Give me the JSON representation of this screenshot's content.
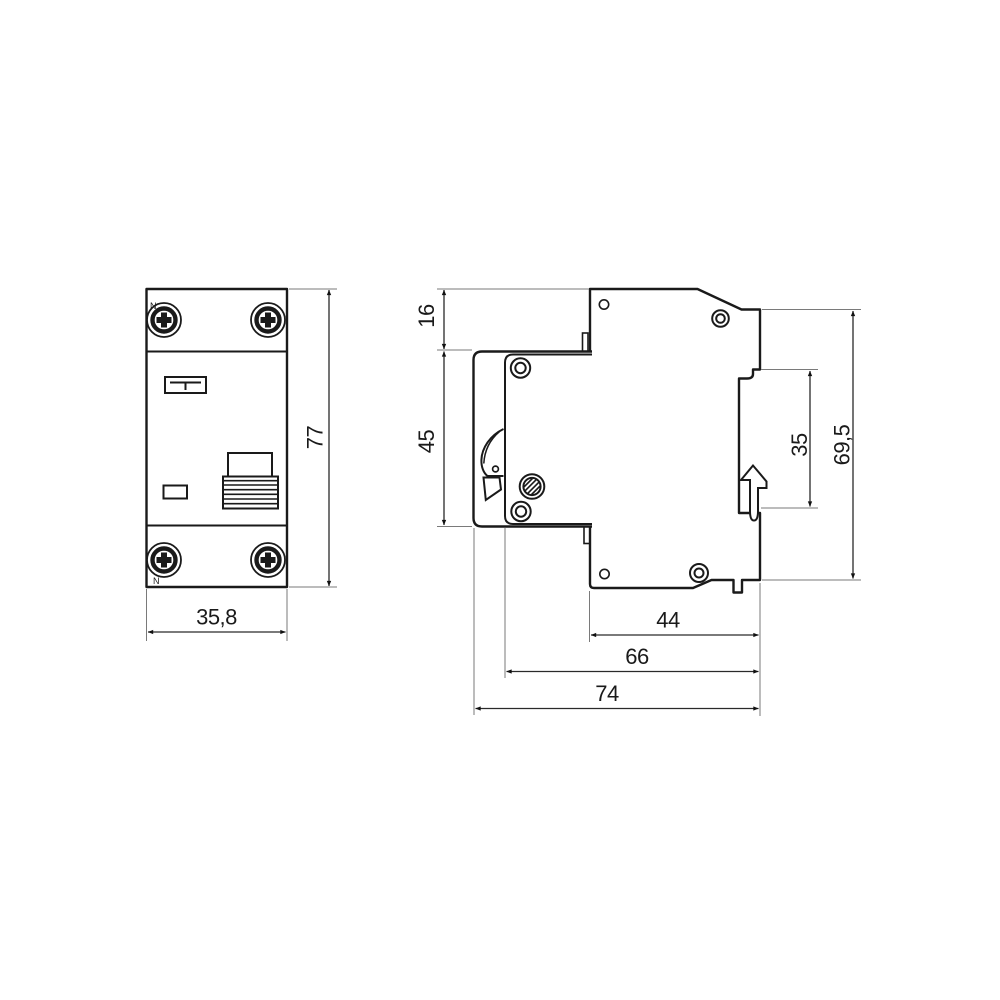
{
  "drawing": {
    "description": "Two-view dimensional drawing of a DIN-rail RCBO circuit breaker",
    "front_view": {
      "terminal_label_top": "N",
      "terminal_label_bottom": "N",
      "dim_width": "35,8",
      "dim_height": "77"
    },
    "side_view": {
      "dim_top_section": "16",
      "dim_front_panel": "45",
      "dim_rail_recess": "35",
      "dim_body_height": "69,5",
      "dim_depth_rear": "44",
      "dim_depth_mid": "66",
      "dim_depth_total": "74"
    },
    "colors": {
      "outline": "#1a1a1a",
      "dimension_line": "#2a2a2a",
      "extension_line": "#7a7a7a",
      "background": "#ffffff"
    }
  }
}
